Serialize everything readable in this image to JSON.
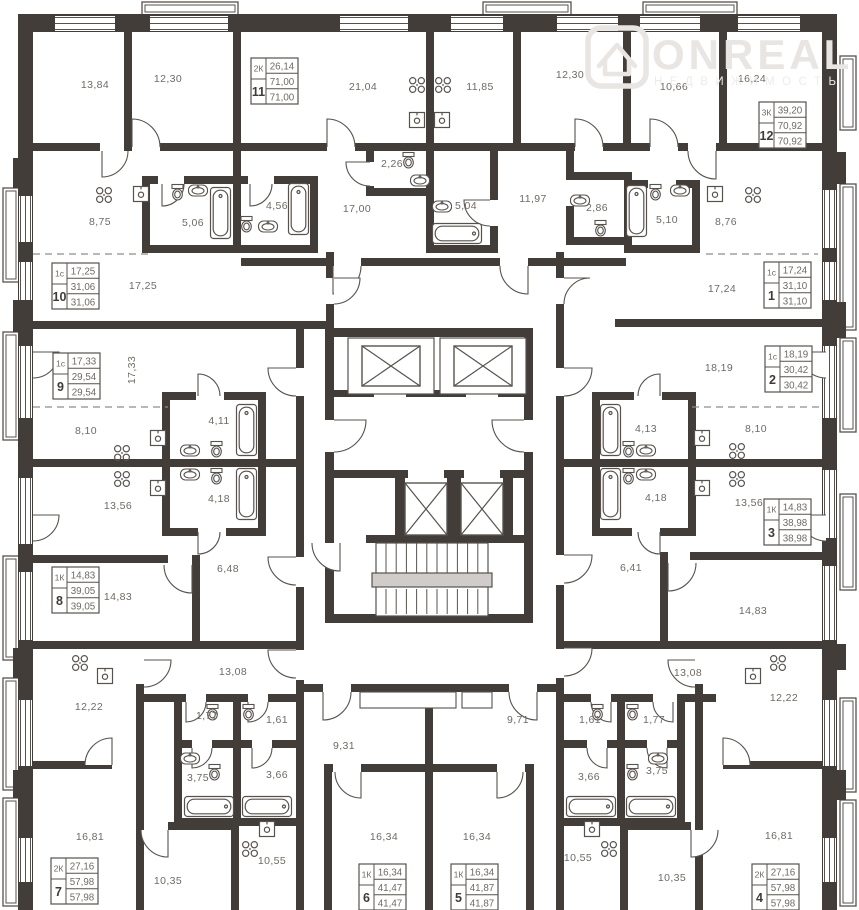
{
  "watermark": {
    "brand": "ONREAL",
    "subtitle": "НЕДВИЖИМОСТЬ"
  },
  "colors": {
    "wall": "#423d39",
    "line": "#57524d",
    "label_text": "#6f6a64",
    "number_text": "#403b37",
    "dashed": "#928c86",
    "watermark": "#e8e5e2",
    "stair_landing": "#cfccc9"
  },
  "room_labels": [
    {
      "text": "13,84",
      "x": 95,
      "y": 88
    },
    {
      "text": "12,30",
      "x": 168,
      "y": 82
    },
    {
      "text": "21,04",
      "x": 363,
      "y": 90
    },
    {
      "text": "11,85",
      "x": 480,
      "y": 90
    },
    {
      "text": "12,30",
      "x": 570,
      "y": 78
    },
    {
      "text": "10,66",
      "x": 674,
      "y": 90
    },
    {
      "text": "16,24",
      "x": 752,
      "y": 82
    },
    {
      "text": "8,75",
      "x": 100,
      "y": 225
    },
    {
      "text": "5,06",
      "x": 193,
      "y": 226
    },
    {
      "text": "4,56",
      "x": 277,
      "y": 209
    },
    {
      "text": "17,00",
      "x": 357,
      "y": 212
    },
    {
      "text": "2,26",
      "x": 392,
      "y": 167
    },
    {
      "text": "5,04",
      "x": 466,
      "y": 209
    },
    {
      "text": "11,97",
      "x": 533,
      "y": 202
    },
    {
      "text": "2,86",
      "x": 597,
      "y": 211
    },
    {
      "text": "5,10",
      "x": 667,
      "y": 223
    },
    {
      "text": "8,76",
      "x": 726,
      "y": 225
    },
    {
      "text": "17,25",
      "x": 143,
      "y": 289
    },
    {
      "text": "17,24",
      "x": 722,
      "y": 292
    },
    {
      "text": "17,33",
      "x": 135,
      "y": 370,
      "rot": -90
    },
    {
      "text": "18,19",
      "x": 719,
      "y": 371
    },
    {
      "text": "8,10",
      "x": 86,
      "y": 434
    },
    {
      "text": "4,11",
      "x": 219,
      "y": 424
    },
    {
      "text": "4,13",
      "x": 646,
      "y": 432
    },
    {
      "text": "8,10",
      "x": 756,
      "y": 432
    },
    {
      "text": "13,56",
      "x": 118,
      "y": 509
    },
    {
      "text": "4,18",
      "x": 219,
      "y": 502
    },
    {
      "text": "4,18",
      "x": 656,
      "y": 501
    },
    {
      "text": "13,56",
      "x": 749,
      "y": 506
    },
    {
      "text": "6,48",
      "x": 228,
      "y": 572
    },
    {
      "text": "6,41",
      "x": 631,
      "y": 571
    },
    {
      "text": "14,83",
      "x": 118,
      "y": 600
    },
    {
      "text": "14,83",
      "x": 753,
      "y": 614
    },
    {
      "text": "12,22",
      "x": 89,
      "y": 710
    },
    {
      "text": "13,08",
      "x": 233,
      "y": 675
    },
    {
      "text": "13,08",
      "x": 688,
      "y": 676
    },
    {
      "text": "12,22",
      "x": 784,
      "y": 701
    },
    {
      "text": "1,77",
      "x": 207,
      "y": 719
    },
    {
      "text": "1,61",
      "x": 277,
      "y": 723
    },
    {
      "text": "1,61",
      "x": 590,
      "y": 723
    },
    {
      "text": "1,77",
      "x": 654,
      "y": 723
    },
    {
      "text": "3,75",
      "x": 198,
      "y": 781
    },
    {
      "text": "3,66",
      "x": 277,
      "y": 778
    },
    {
      "text": "3,66",
      "x": 589,
      "y": 780
    },
    {
      "text": "3,75",
      "x": 657,
      "y": 774
    },
    {
      "text": "9,31",
      "x": 344,
      "y": 749
    },
    {
      "text": "9,71",
      "x": 518,
      "y": 723
    },
    {
      "text": "16,81",
      "x": 90,
      "y": 840
    },
    {
      "text": "10,35",
      "x": 168,
      "y": 884
    },
    {
      "text": "10,55",
      "x": 272,
      "y": 864
    },
    {
      "text": "16,34",
      "x": 384,
      "y": 840
    },
    {
      "text": "16,34",
      "x": 477,
      "y": 840
    },
    {
      "text": "10,55",
      "x": 578,
      "y": 861
    },
    {
      "text": "10,35",
      "x": 672,
      "y": 881
    },
    {
      "text": "16,81",
      "x": 779,
      "y": 839
    }
  ],
  "apartments": [
    {
      "number": "11",
      "type": "2К",
      "room_area": "26,14",
      "total_area": "71,00",
      "total_area_2": "71,00",
      "x": 251,
      "y": 58
    },
    {
      "number": "12",
      "type": "3К",
      "room_area": "39,20",
      "total_area": "70,92",
      "total_area_2": "70,92",
      "x": 759,
      "y": 102
    },
    {
      "number": "10",
      "type": "1с",
      "room_area": "17,25",
      "total_area": "31,06",
      "total_area_2": "31,06",
      "x": 52,
      "y": 263
    },
    {
      "number": "1",
      "type": "1с",
      "room_area": "17,24",
      "total_area": "31,10",
      "total_area_2": "31,10",
      "x": 764,
      "y": 262
    },
    {
      "number": "9",
      "type": "1с",
      "room_area": "17,33",
      "total_area": "29,54",
      "total_area_2": "29,54",
      "x": 53,
      "y": 353
    },
    {
      "number": "2",
      "type": "1с",
      "room_area": "18,19",
      "total_area": "30,42",
      "total_area_2": "30,42",
      "x": 765,
      "y": 346
    },
    {
      "number": "8",
      "type": "1К",
      "room_area": "14,83",
      "total_area": "39,05",
      "total_area_2": "39,05",
      "x": 52,
      "y": 567
    },
    {
      "number": "3",
      "type": "1К",
      "room_area": "14,83",
      "total_area": "38,98",
      "total_area_2": "38,98",
      "x": 764,
      "y": 499
    },
    {
      "number": "7",
      "type": "2К",
      "room_area": "27,16",
      "total_area": "57,98",
      "total_area_2": "57,98",
      "x": 51,
      "y": 858
    },
    {
      "number": "4",
      "type": "2К",
      "room_area": "27,16",
      "total_area": "57,98",
      "total_area_2": "57,98",
      "x": 752,
      "y": 864
    },
    {
      "number": "6",
      "type": "1К",
      "room_area": "16,34",
      "total_area": "41,47",
      "total_area_2": "41,47",
      "x": 359,
      "y": 864
    },
    {
      "number": "5",
      "type": "1К",
      "room_area": "16,34",
      "total_area": "41,87",
      "total_area_2": "41,87",
      "x": 451,
      "y": 864
    }
  ]
}
